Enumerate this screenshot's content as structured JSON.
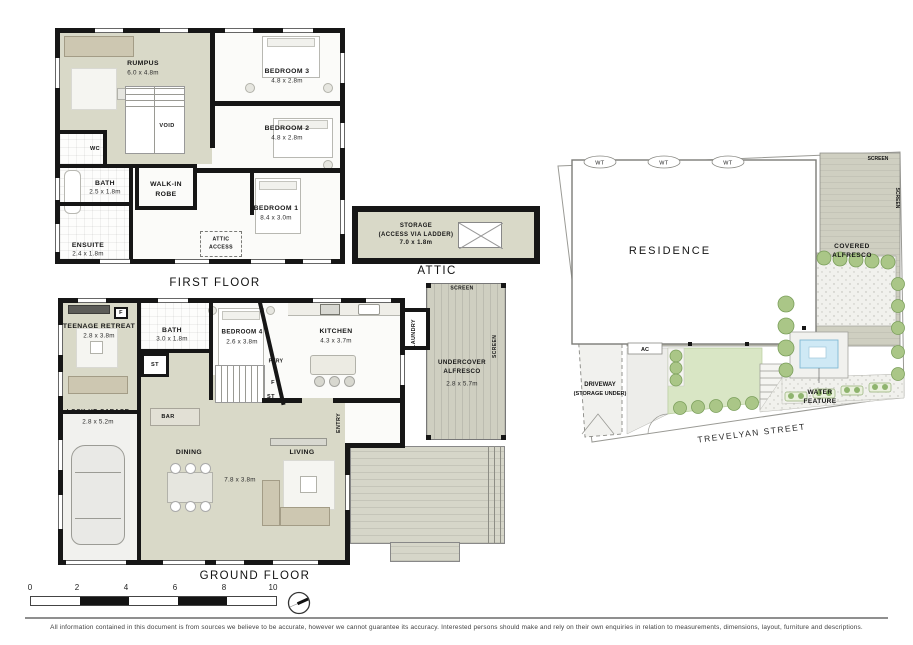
{
  "titles": {
    "first_floor": "FIRST FLOOR",
    "attic": "ATTIC",
    "ground_floor": "GROUND FLOOR"
  },
  "first_floor": {
    "rumpus": {
      "name": "RUMPUS",
      "dims": "6.0 x 4.8m"
    },
    "bedroom3": {
      "name": "BEDROOM 3",
      "dims": "4.8 x 2.8m"
    },
    "bedroom2": {
      "name": "BEDROOM 2",
      "dims": "4.8 x 2.8m"
    },
    "bedroom1": {
      "name": "BEDROOM 1",
      "dims": "8.4 x 3.0m"
    },
    "bath": {
      "name": "BATH",
      "dims": "2.5 x 1.8m"
    },
    "ensuite": {
      "name": "ENSUITE",
      "dims": "2.4 x 1.8m"
    },
    "wc": "WC",
    "walk_in_robe": "WALK-IN\nROBE",
    "void": "VOID",
    "attic_access": "ATTIC\nACCESS"
  },
  "attic": {
    "storage": "STORAGE\n(ACCESS VIA LADDER)\n7.0 x 1.8m"
  },
  "ground_floor": {
    "teenage_retreat": {
      "name": "TEENAGE RETREAT",
      "dims": "2.8 x 3.8m"
    },
    "bath": {
      "name": "BATH",
      "dims": "3.0 x 1.8m"
    },
    "bedroom4": {
      "name": "BEDROOM 4",
      "dims": "2.6 x 3.8m"
    },
    "kitchen": {
      "name": "KITCHEN",
      "dims": "4.3 x 3.7m"
    },
    "garage": {
      "name": "LOCK-UP GARAGE",
      "dims": "2.8 x 5.2m"
    },
    "alfresco": {
      "name": "UNDERCOVER\nALFRESCO",
      "dims": "2.8 x 5.7m"
    },
    "dining": "DINING",
    "living": "LIVING",
    "living_dining_dims": "7.8 x 3.8m",
    "bar": "BAR",
    "laundry": "LAUNDRY",
    "entry": "ENTRY",
    "pantry": "PTRY",
    "fridge": "F",
    "fridge2": "F",
    "store": "ST",
    "store2": "ST",
    "screen_top": "SCREEN",
    "screen_side": "SCREEN"
  },
  "site_plan": {
    "residence": "RESIDENCE",
    "covered_alfresco_1": "COVERED",
    "covered_alfresco_2": "ALFRESCO",
    "driveway_1": "DRIVEWAY",
    "driveway_2": "(STORAGE UNDER)",
    "water_feature_1": "WATER",
    "water_feature_2": "FEATURE",
    "street": "TREVELYAN STREET",
    "wt1": "WT",
    "wt2": "WT",
    "wt3": "WT",
    "ac": "AC",
    "screen_top": "SCREEN",
    "screen_side": "SCREEN"
  },
  "scale_bar": {
    "t0": "0",
    "t1": "2",
    "t2": "4",
    "t3": "6",
    "t4": "8",
    "t5": "10"
  },
  "disclaimer": "All information contained in this document is from sources we believe to be accurate, however we cannot guarantee its accuracy. Interested persons should make and rely on their own enquiries in relation to measurements, dimensions, layout, furniture and descriptions."
}
